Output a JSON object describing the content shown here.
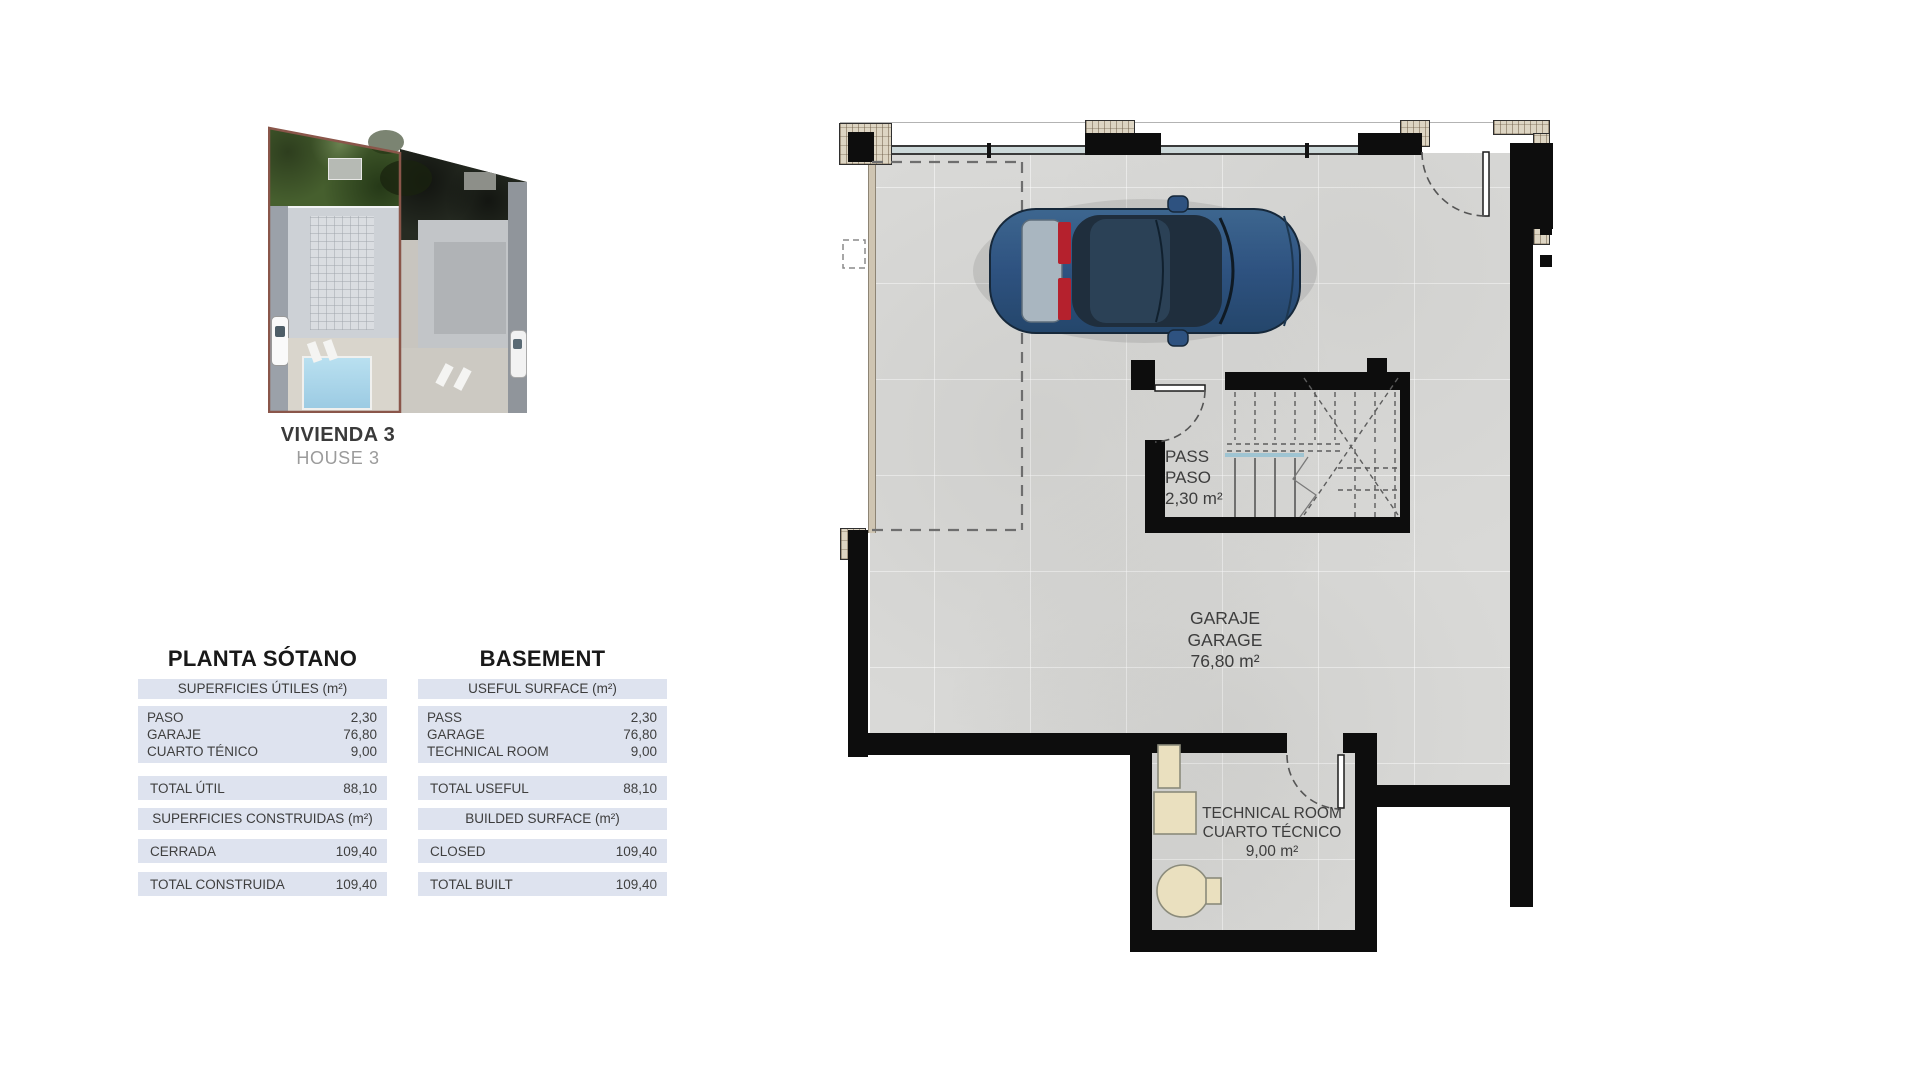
{
  "site_thumbnail": {
    "title": "VIVIENDA 3",
    "subtitle": "HOUSE 3"
  },
  "surface_tables": [
    {
      "title": "PLANTA SÓTANO",
      "useful_header": "SUPERFICIES ÚTILES (m²)",
      "rooms": [
        {
          "label": "PASO",
          "value": "2,30"
        },
        {
          "label": "GARAJE",
          "value": "76,80"
        },
        {
          "label": "CUARTO TÉNICO",
          "value": "9,00"
        }
      ],
      "total_useful": {
        "label": "TOTAL ÚTIL",
        "value": "88,10"
      },
      "built_header": "SUPERFICIES CONSTRUIDAS (m²)",
      "closed": {
        "label": "CERRADA",
        "value": "109,40"
      },
      "total_built": {
        "label": "TOTAL CONSTRUIDA",
        "value": "109,40"
      }
    },
    {
      "title": "BASEMENT",
      "useful_header": "USEFUL SURFACE (m²)",
      "rooms": [
        {
          "label": "PASS",
          "value": "2,30"
        },
        {
          "label": "GARAGE",
          "value": "76,80"
        },
        {
          "label": "TECHNICAL ROOM",
          "value": "9,00"
        }
      ],
      "total_useful": {
        "label": "TOTAL USEFUL",
        "value": "88,10"
      },
      "built_header": "BUILDED SURFACE (m²)",
      "closed": {
        "label": "CLOSED",
        "value": "109,40"
      },
      "total_built": {
        "label": "TOTAL BUILT",
        "value": "109,40"
      }
    }
  ],
  "floor_plan": {
    "labels": [
      {
        "line1": "PASS",
        "line2": "PASO",
        "line3": "2,30 m²"
      },
      {
        "line1": "GARAJE",
        "line2": "GARAGE",
        "line3": "76,80 m²"
      },
      {
        "line1": "TECHNICAL ROOM",
        "line2": "CUARTO TÉCNICO",
        "line3": "9,00 m²"
      }
    ]
  },
  "colors": {
    "wall": "#0d0d0d",
    "floor": "#d9d9d7",
    "table_row_bg": "#dee3ef",
    "accent_outline": "#8a564a",
    "pool": "#a6d6ea",
    "car_body": "#2e5280",
    "taillight": "#b5212d",
    "equipment": "#eae0bf"
  }
}
